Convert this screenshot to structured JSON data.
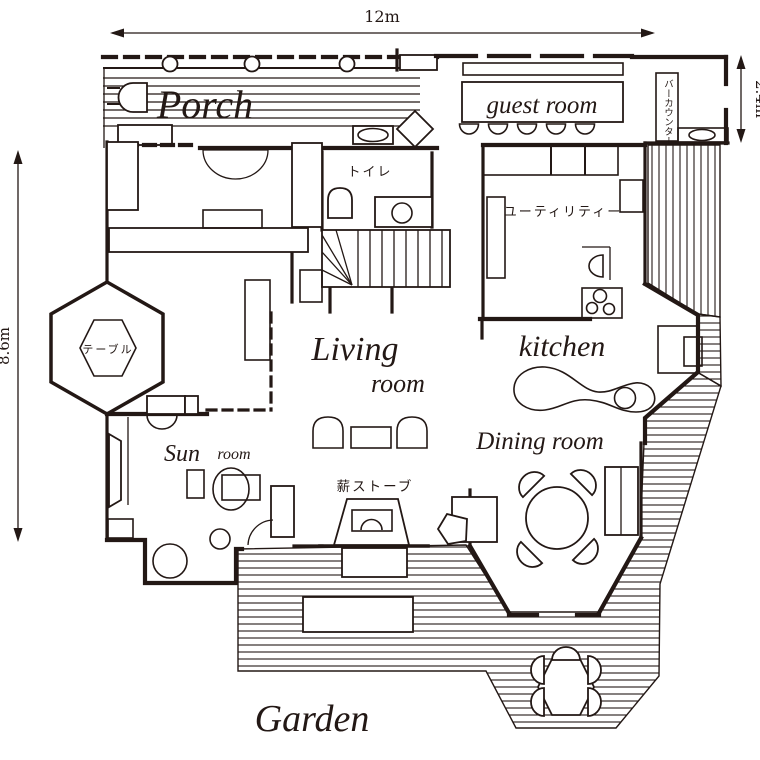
{
  "dimensions": {
    "top": "12m",
    "right": "2.4m",
    "left": "8.6m"
  },
  "rooms": {
    "porch": "Porch",
    "guest_room": "guest room",
    "bar_counter": "バーカウンター",
    "toilet": "トイレ",
    "utility": "ユーティリティー",
    "living_line1": "Living",
    "living_line2": "room",
    "kitchen": "kitchen",
    "dining": "Dining room",
    "sun_line1": "Sun",
    "sun_line2": "room",
    "table": "テーブル",
    "wood_stove": "薪ストーブ",
    "garden": "Garden"
  },
  "colors": {
    "ink": "#231815",
    "background": "#ffffff"
  }
}
